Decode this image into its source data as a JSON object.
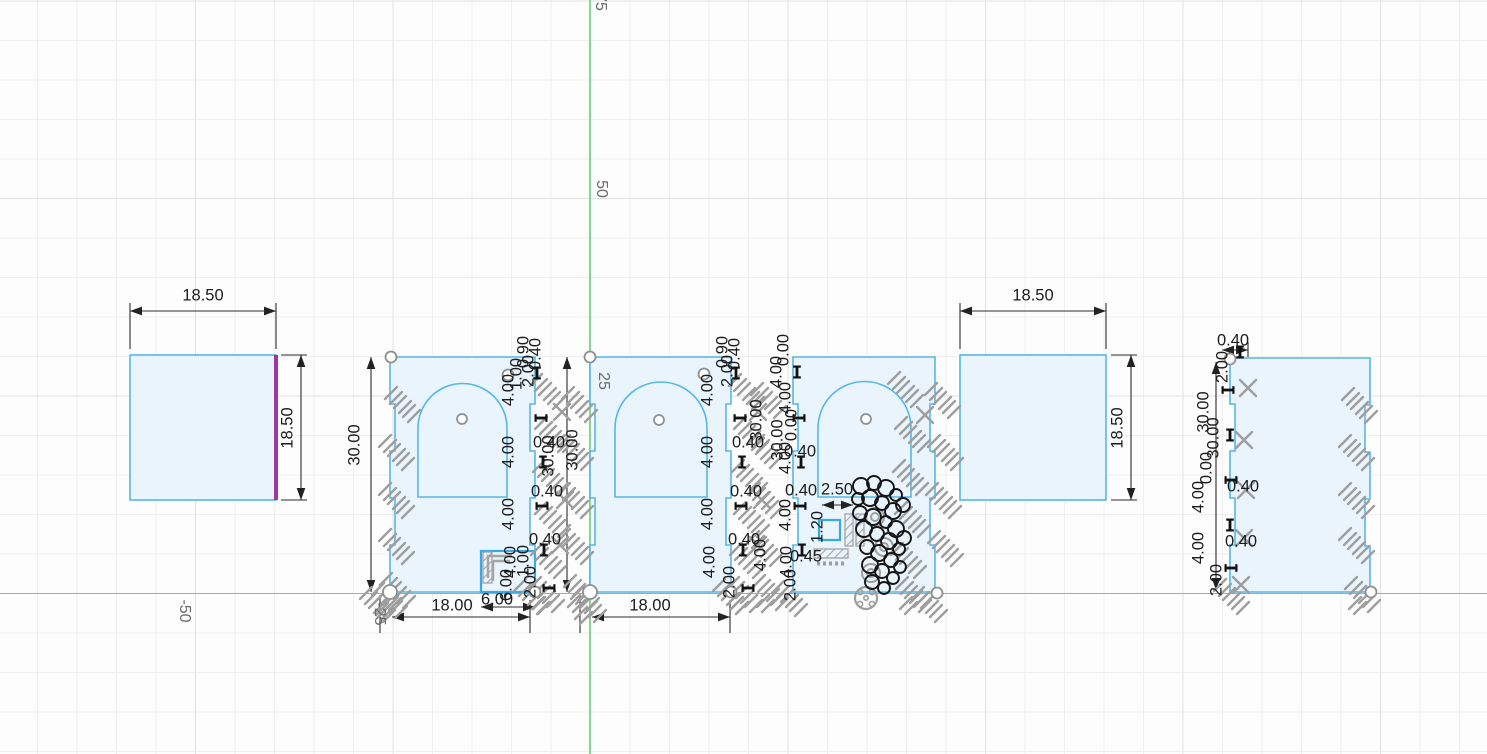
{
  "app": {
    "description": "CAD sketch view with grid, axes, dimensioned laser-cut panels",
    "canvas": {
      "width": 1487,
      "height": 754
    }
  },
  "colors": {
    "grid_minor": "#efefef",
    "grid_major": "#e1e1e1",
    "axis_x": "#ea8c8c",
    "axis_y": "#8fd28f",
    "sketch_fill": "#e9f4fc",
    "sketch_stroke": "#55b7e8",
    "cutout_stroke": "#35aae4",
    "selected_edge": "#a136a0",
    "dimension_text": "#1c1c1c",
    "constraint_glyph": "#9e9e9e",
    "axis_label": "#6b6b6b"
  },
  "axis_labels": [
    [
      "75",
      600,
      2,
      90
    ],
    [
      "50",
      601,
      189,
      90
    ],
    [
      "25",
      603,
      381,
      90
    ],
    [
      "-25",
      379,
      614,
      90
    ],
    [
      "-50",
      184,
      611,
      90
    ]
  ],
  "shapes": [
    {
      "kind": "square",
      "name": "square-panel-left",
      "x": 130,
      "y": 355,
      "w": 146,
      "h": 145,
      "selected_edge": "right"
    },
    {
      "kind": "panel",
      "name": "arch-panel-1",
      "left": 390,
      "right": 535,
      "top": 357,
      "bottom": 592,
      "arch": {
        "x1": 418,
        "x2": 507,
        "cy": 428,
        "yb": 497
      },
      "pin": {
        "cx": 462,
        "cy": 419
      },
      "cutout": {
        "x": 481,
        "y": 551,
        "w": 54,
        "h": 41
      }
    },
    {
      "kind": "panel",
      "name": "arch-panel-2",
      "left": 590,
      "right": 731,
      "top": 357,
      "bottom": 592,
      "arch": {
        "x1": 615,
        "x2": 707,
        "cy": 428,
        "yb": 497
      },
      "pin": {
        "cx": 659,
        "cy": 420
      }
    },
    {
      "kind": "panel",
      "name": "arch-panel-3",
      "left": 793,
      "right": 935,
      "top": 357,
      "bottom": 592,
      "arch": {
        "x1": 818,
        "x2": 911,
        "cy": 428,
        "yb": 497
      },
      "pin": {
        "cx": 866,
        "cy": 419
      }
    },
    {
      "kind": "square",
      "name": "square-panel-right",
      "x": 960,
      "y": 355,
      "w": 146,
      "h": 145
    },
    {
      "kind": "panel",
      "name": "plain-panel",
      "left": 1230,
      "right": 1370,
      "top": 358,
      "bottom": 592
    }
  ],
  "inner_details": {
    "blue_rect": {
      "x": 819,
      "y": 520,
      "w": 21,
      "h": 20
    },
    "hatch_bars": [
      [
        483,
        552,
        9,
        31
      ],
      [
        845,
        514,
        8,
        32
      ],
      [
        856,
        514,
        8,
        32
      ],
      [
        814,
        549,
        34,
        9
      ]
    ],
    "dotted_bar": [
      817,
      561,
      30,
      5
    ],
    "brackets": [
      [
        [
          488,
          578
        ],
        [
          488,
          556
        ],
        [
          512,
          556
        ]
      ],
      [
        [
          493,
          581
        ],
        [
          493,
          561
        ],
        [
          510,
          561
        ]
      ]
    ]
  },
  "dim_lines": [
    [
      130,
      311,
      276,
      311,
      1
    ],
    [
      130,
      303,
      130,
      349,
      0
    ],
    [
      276,
      303,
      276,
      349,
      0
    ],
    [
      301,
      355,
      301,
      500,
      1
    ],
    [
      281,
      355,
      307,
      355,
      0
    ],
    [
      281,
      500,
      307,
      500,
      0
    ],
    [
      960,
      311,
      1106,
      311,
      1
    ],
    [
      960,
      303,
      960,
      349,
      0
    ],
    [
      1106,
      303,
      1106,
      349,
      0
    ],
    [
      1131,
      355,
      1131,
      500,
      1
    ],
    [
      1111,
      355,
      1137,
      355,
      0
    ],
    [
      1111,
      500,
      1137,
      500,
      0
    ],
    [
      371,
      357,
      371,
      592,
      1
    ],
    [
      392,
      617,
      530,
      617,
      1
    ],
    [
      380,
      595,
      380,
      633,
      0
    ],
    [
      530,
      600,
      530,
      633,
      0
    ],
    [
      481,
      607,
      535,
      607,
      1
    ],
    [
      567,
      357,
      567,
      592,
      1
    ],
    [
      592,
      617,
      730,
      617,
      1
    ],
    [
      580,
      595,
      580,
      633,
      0
    ],
    [
      730,
      600,
      730,
      633,
      0
    ],
    [
      822,
      505,
      853,
      505,
      1
    ],
    [
      1216,
      362,
      1216,
      590,
      1
    ],
    [
      1222,
      350,
      1248,
      350,
      1
    ],
    [
      1248,
      342,
      1248,
      357,
      0
    ]
  ],
  "dimensions": [
    [
      "18.50",
      203,
      296,
      0
    ],
    [
      "18.50",
      288,
      428,
      -90
    ],
    [
      "18.50",
      1033,
      296,
      0
    ],
    [
      "18.50",
      1118,
      428,
      -90
    ],
    [
      "30.00",
      355,
      445,
      -90
    ],
    [
      "18.00",
      452,
      606,
      0
    ],
    [
      "6.00",
      497,
      600,
      0
    ],
    [
      "18.00",
      650,
      606,
      0
    ],
    [
      "30.00",
      549,
      456,
      -90
    ],
    [
      "30.00",
      573,
      450,
      -90
    ],
    [
      "2.50",
      837,
      490,
      0
    ],
    [
      "0.40",
      1233,
      341,
      0
    ],
    [
      "4.00",
      509,
      390,
      -90
    ],
    [
      "4.00",
      509,
      452,
      -90
    ],
    [
      "4.00",
      509,
      514,
      -90
    ],
    [
      "4.00",
      511,
      562,
      -90
    ],
    [
      "0.40",
      549,
      443,
      0
    ],
    [
      "0.40",
      547,
      492,
      0
    ],
    [
      "0.40",
      545,
      540,
      0
    ],
    [
      "0.90",
      524,
      352,
      -90
    ],
    [
      "0.40",
      536,
      354,
      -90
    ],
    [
      "2.00",
      529,
      371,
      -90
    ],
    [
      "1.00",
      517,
      374,
      -90
    ],
    [
      "1.00",
      524,
      561,
      -90
    ],
    [
      "2.00",
      531,
      582,
      -90
    ],
    [
      "6.00",
      507,
      585,
      -90
    ],
    [
      "4.00",
      708,
      390,
      -90
    ],
    [
      "4.00",
      708,
      452,
      -90
    ],
    [
      "4.00",
      708,
      514,
      -90
    ],
    [
      "4.00",
      710,
      562,
      -90
    ],
    [
      "0.40",
      748,
      443,
      0
    ],
    [
      "0.40",
      746,
      492,
      0
    ],
    [
      "0.40",
      744,
      540,
      0
    ],
    [
      "0.90",
      723,
      352,
      -90
    ],
    [
      "0.40",
      735,
      354,
      -90
    ],
    [
      "2.00",
      728,
      371,
      -90
    ],
    [
      "2.00",
      730,
      582,
      -90
    ],
    [
      "30.00",
      757,
      420,
      -90
    ],
    [
      "4.00",
      761,
      555,
      -90
    ],
    [
      "0.00",
      784,
      350,
      -90
    ],
    [
      "4.00",
      777,
      372,
      -90
    ],
    [
      "4.00",
      786,
      398,
      -90
    ],
    [
      "0.00",
      792,
      425,
      -90
    ],
    [
      "30.00",
      778,
      440,
      -90
    ],
    [
      "4.00",
      786,
      458,
      -90
    ],
    [
      "0.40",
      800,
      452,
      0
    ],
    [
      "4.00",
      786,
      515,
      -90
    ],
    [
      "0.40",
      801,
      491,
      0
    ],
    [
      "4.00",
      787,
      562,
      -90
    ],
    [
      "2.00",
      791,
      585,
      -90
    ],
    [
      "0.45",
      806,
      557,
      0
    ],
    [
      "1.20",
      818,
      527,
      -90
    ],
    [
      "2.00",
      1223,
      367,
      -90
    ],
    [
      "30.00",
      1204,
      412,
      -90
    ],
    [
      "30.00",
      1214,
      438,
      -90
    ],
    [
      "0.00",
      1207,
      468,
      -90
    ],
    [
      "4.00",
      1199,
      497,
      -90
    ],
    [
      "4.00",
      1199,
      548,
      -90
    ],
    [
      "2.00",
      1217,
      580,
      -90
    ],
    [
      "0.40",
      1243,
      487,
      0
    ],
    [
      "0.40",
      1241,
      542,
      0
    ]
  ],
  "ticks": [
    [
      537,
      373
    ],
    [
      541,
      418
    ],
    [
      543,
      462
    ],
    [
      542,
      506
    ],
    [
      544,
      550
    ],
    [
      549,
      588
    ],
    [
      736,
      373
    ],
    [
      740,
      418
    ],
    [
      742,
      462
    ],
    [
      741,
      506
    ],
    [
      743,
      550
    ],
    [
      748,
      588
    ],
    [
      797,
      372
    ],
    [
      799,
      418
    ],
    [
      801,
      462
    ],
    [
      800,
      506
    ],
    [
      802,
      550
    ],
    [
      1228,
      390
    ],
    [
      1230,
      435
    ],
    [
      1231,
      480
    ],
    [
      1230,
      525
    ],
    [
      1231,
      568
    ],
    [
      1240,
      352
    ]
  ],
  "glyphs": [
    [
      "p3",
      403,
      404
    ],
    [
      "p3",
      397,
      452
    ],
    [
      "p3",
      397,
      500
    ],
    [
      "p3",
      397,
      546
    ],
    [
      "p4",
      398,
      590
    ],
    [
      "p3",
      548,
      391
    ],
    [
      "p3",
      553,
      434
    ],
    [
      "p3",
      551,
      477
    ],
    [
      "p3",
      553,
      519
    ],
    [
      "p3",
      549,
      560
    ],
    [
      "p4",
      547,
      594
    ],
    [
      "p3",
      580,
      404
    ],
    [
      "p3",
      576,
      452
    ],
    [
      "p3",
      576,
      500
    ],
    [
      "p3",
      576,
      546
    ],
    [
      "p4",
      582,
      592
    ],
    [
      "p3",
      747,
      391
    ],
    [
      "p3",
      752,
      434
    ],
    [
      "p3",
      750,
      477
    ],
    [
      "p3",
      752,
      519
    ],
    [
      "p3",
      748,
      560
    ],
    [
      "p4",
      745,
      594
    ],
    [
      "p3",
      769,
      400
    ],
    [
      "p3",
      765,
      450
    ],
    [
      "p3",
      766,
      500
    ],
    [
      "p3",
      765,
      548
    ],
    [
      "p4",
      771,
      592
    ],
    [
      "p3",
      906,
      389
    ],
    [
      "p3",
      913,
      434
    ],
    [
      "p3",
      911,
      477
    ],
    [
      "p3",
      913,
      519
    ],
    [
      "p3",
      909,
      560
    ],
    [
      "p4",
      914,
      594
    ],
    [
      "p3",
      943,
      400
    ],
    [
      "p3",
      946,
      452
    ],
    [
      "p3",
      944,
      500
    ],
    [
      "p3",
      946,
      548
    ],
    [
      "p3",
      1360,
      405
    ],
    [
      "p3",
      1357,
      452
    ],
    [
      "p3",
      1357,
      500
    ],
    [
      "p3",
      1357,
      545
    ],
    [
      "p4",
      1363,
      594
    ],
    [
      "x",
      1248,
      388
    ],
    [
      "x",
      1244,
      440
    ],
    [
      "x",
      1246,
      490
    ],
    [
      "x",
      1244,
      538
    ],
    [
      "x",
      1241,
      585
    ],
    [
      "x",
      562,
      412
    ],
    [
      "x",
      565,
      500
    ],
    [
      "x",
      560,
      545
    ],
    [
      "x",
      758,
      412
    ],
    [
      "x",
      762,
      500
    ],
    [
      "x",
      758,
      545
    ],
    [
      "x",
      925,
      415
    ],
    [
      "p4",
      589,
      604
    ],
    [
      "p3",
      378,
      604
    ],
    [
      "p4",
      390,
      600
    ],
    [
      "p3",
      532,
      596
    ],
    [
      "p3",
      731,
      596
    ],
    [
      "p3",
      790,
      598
    ],
    [
      "p3",
      930,
      604
    ],
    [
      "p3",
      1232,
      596
    ],
    [
      "cc",
      875,
      517
    ],
    [
      "cc",
      884,
      547
    ],
    [
      "cc",
      871,
      573
    ],
    [
      "fl",
      866,
      598
    ]
  ],
  "handles": [
    [
      391,
      357,
      5.5
    ],
    [
      390,
      592,
      7
    ],
    [
      535,
      592,
      5.5
    ],
    [
      508,
      375,
      5.5
    ],
    [
      590,
      357,
      5.5
    ],
    [
      590,
      592,
      7
    ],
    [
      731,
      592,
      5.5
    ],
    [
      704,
      374,
      5.5
    ],
    [
      937,
      593,
      5.5
    ],
    [
      1230,
      359,
      5.5
    ],
    [
      1371,
      592,
      5.5
    ]
  ],
  "blob_circles": [
    [
      861,
      486,
      8
    ],
    [
      874,
      483,
      7
    ],
    [
      886,
      488,
      8
    ],
    [
      896,
      495,
      6
    ],
    [
      903,
      505,
      7
    ],
    [
      858,
      499,
      6
    ],
    [
      870,
      498,
      8
    ],
    [
      882,
      503,
      7
    ],
    [
      893,
      511,
      8
    ],
    [
      860,
      513,
      7
    ],
    [
      873,
      517,
      8
    ],
    [
      886,
      522,
      6
    ],
    [
      896,
      529,
      8
    ],
    [
      904,
      538,
      7
    ],
    [
      864,
      529,
      8
    ],
    [
      877,
      534,
      7
    ],
    [
      889,
      541,
      8
    ],
    [
      899,
      549,
      6
    ],
    [
      867,
      547,
      7
    ],
    [
      879,
      553,
      8
    ],
    [
      891,
      560,
      7
    ],
    [
      900,
      567,
      6
    ],
    [
      870,
      565,
      8
    ],
    [
      882,
      571,
      7
    ],
    [
      893,
      578,
      6
    ],
    [
      872,
      582,
      7
    ],
    [
      884,
      588,
      6
    ]
  ]
}
